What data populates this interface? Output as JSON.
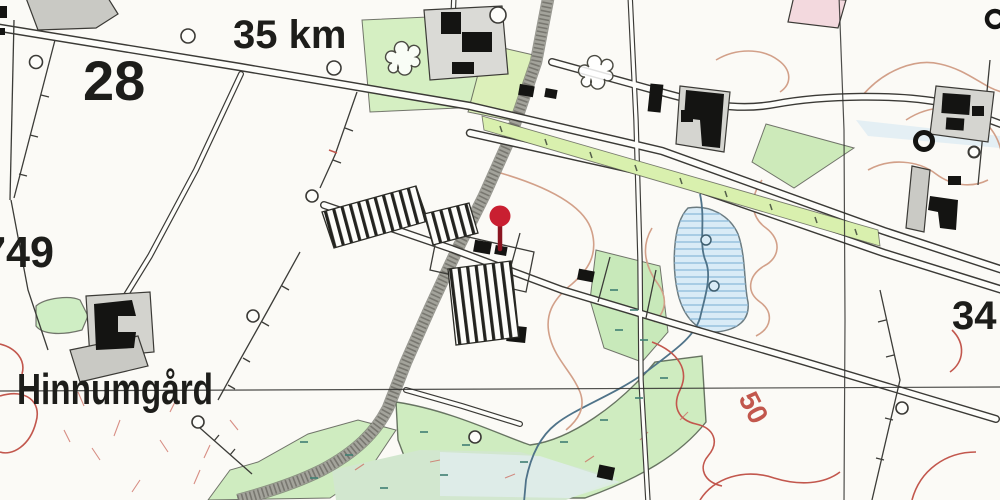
{
  "map": {
    "type": "historical-topographic-map",
    "labels": {
      "distance_marker": "35 km",
      "grid_number_topleft": "28",
      "grid_number_left": "749",
      "place_name": "Hinnumgård",
      "grid_number_right": "34",
      "contour_elevation": "50"
    },
    "pin": {
      "x": 500,
      "y": 217,
      "head_color": "#c91f31",
      "stem_color": "#8a1420"
    },
    "colors": {
      "paper": "#fbfaf6",
      "field_green": "#d5efc2",
      "strip_green": "#d9f0ae",
      "meadow_green": "#cfecc0",
      "pale_meadow": "#d2e7cf",
      "water_blue": "#d9ebf6",
      "water_hatch": "#8cb9da",
      "stream_blue": "#4f7389",
      "contour_tan": "#d2a089",
      "contour_red": "#c2574d",
      "railway_gray": "#a3a39b",
      "building_black": "#141412",
      "building_gray": "#cdcdc7",
      "pink_building": "#f3d9de",
      "ink": "#3b3a36"
    }
  }
}
